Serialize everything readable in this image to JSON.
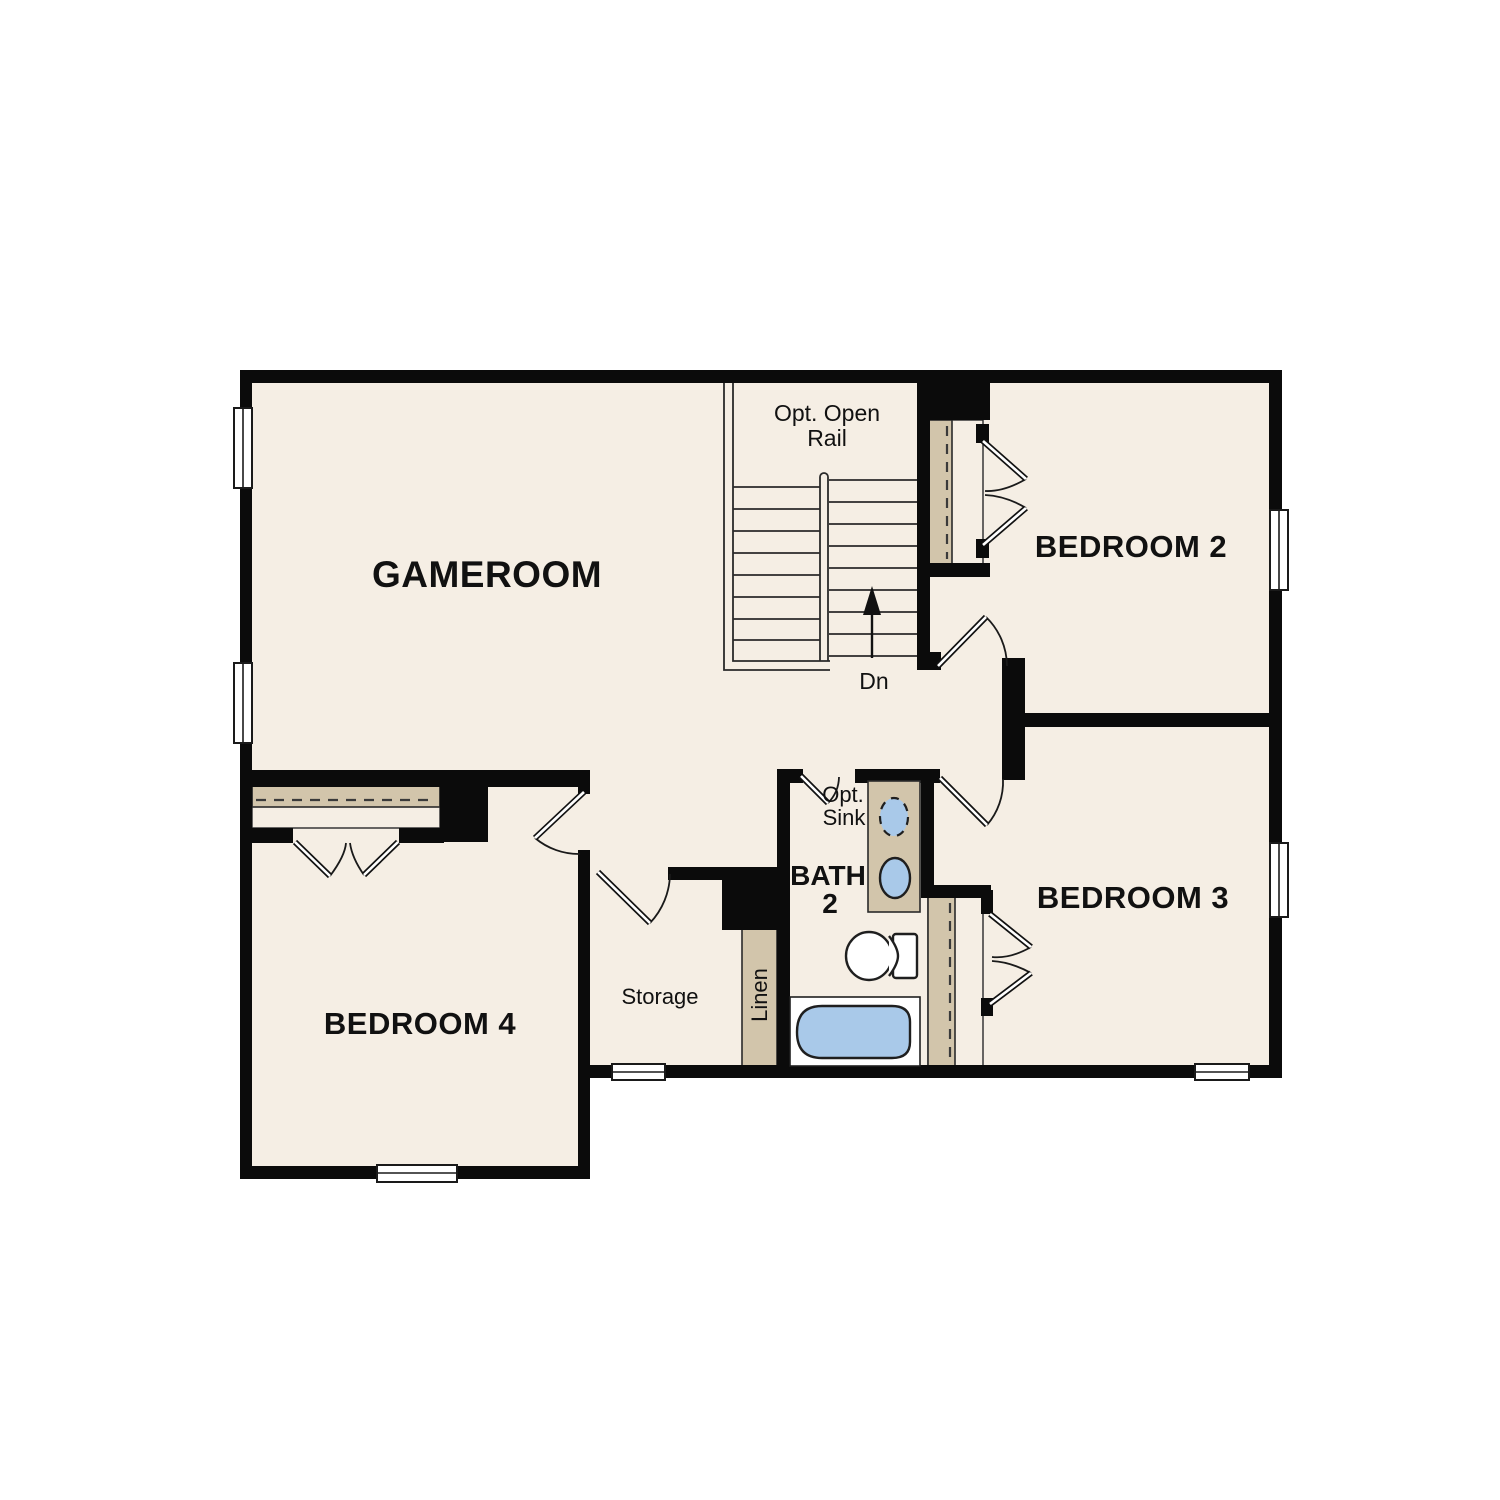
{
  "plan": {
    "type": "second-floor-plan",
    "rooms": {
      "gameroom": {
        "label": "GAMEROOM"
      },
      "bedroom2": {
        "label": "BEDROOM 2"
      },
      "bedroom3": {
        "label": "BEDROOM 3"
      },
      "bedroom4": {
        "label": "BEDROOM 4"
      },
      "bath2": {
        "label_line1": "BATH",
        "label_line2": "2"
      },
      "storage": {
        "label": "Storage"
      },
      "linen": {
        "label": "Linen"
      }
    },
    "annotations": {
      "stair_note_line1": "Opt. Open",
      "stair_note_line2": "Rail",
      "stair_direction": "Dn",
      "optional_sink_line1": "Opt.",
      "optional_sink_line2": "Sink"
    },
    "colors": {
      "floor": "#f5eee4",
      "wall": "#0b0b0b",
      "closet_shading": "#d2c5ab",
      "fixture_water": "#a9c9e9",
      "background": "#ffffff"
    }
  }
}
